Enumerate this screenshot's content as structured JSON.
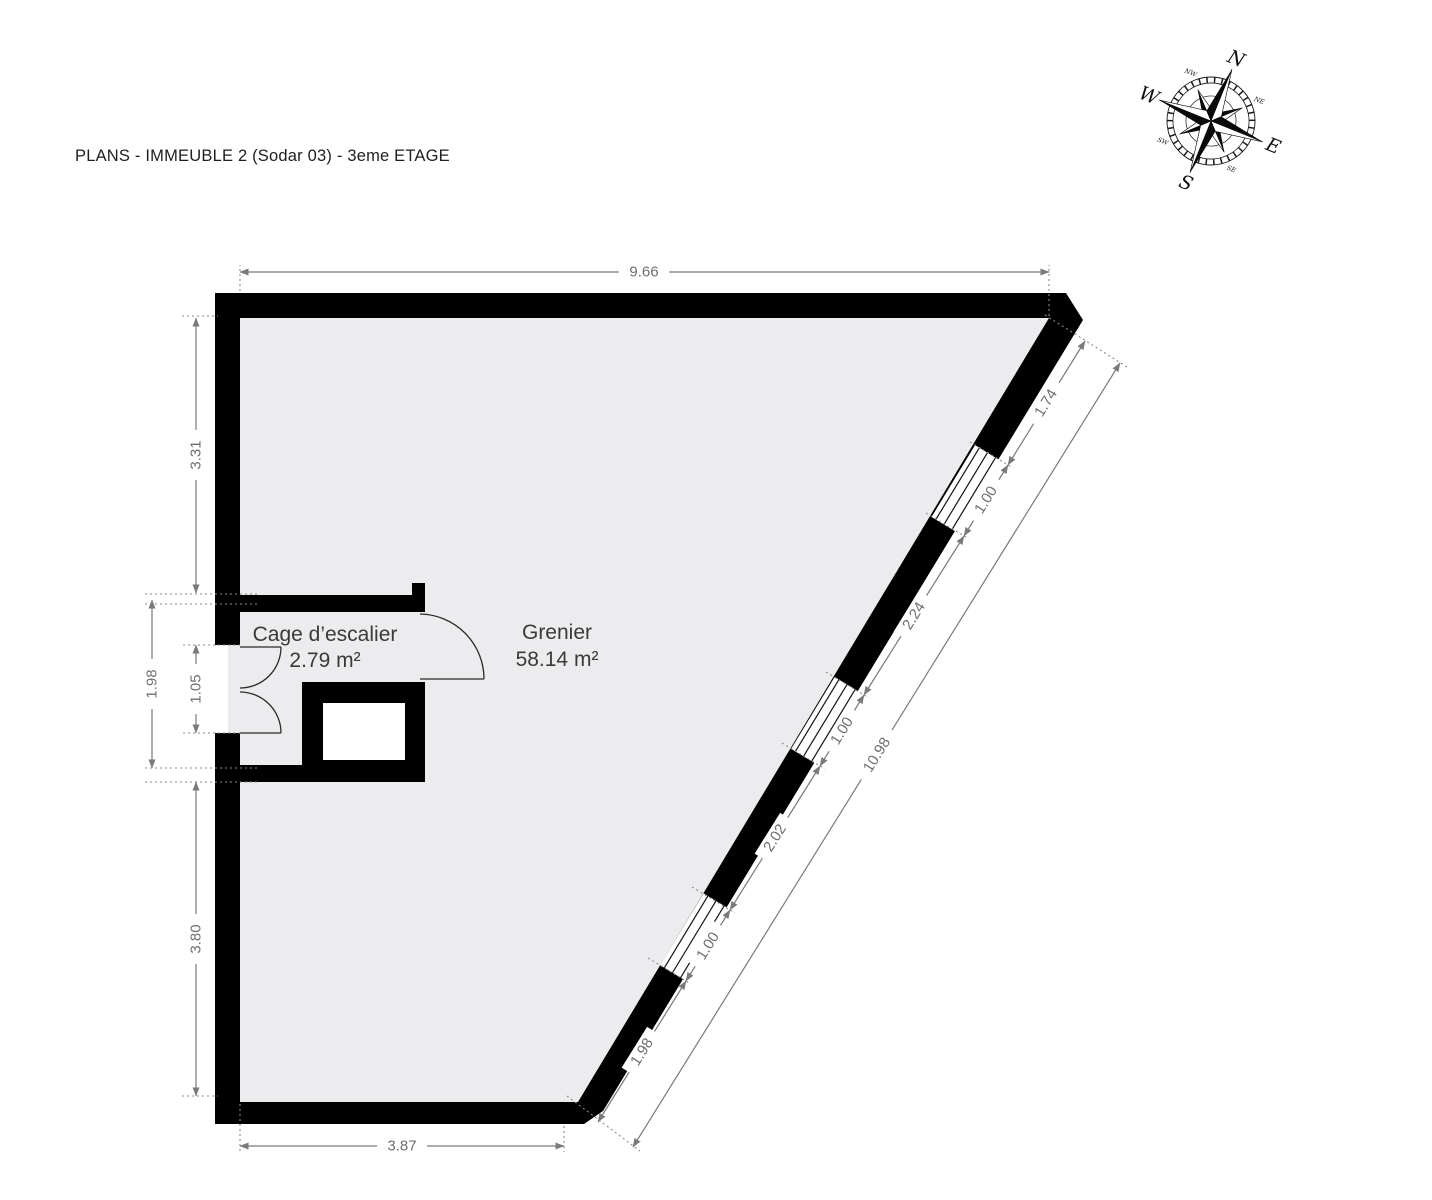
{
  "title": "PLANS - IMMEUBLE 2 (Sodar 03) - 3eme ETAGE",
  "rooms": {
    "stairwell": {
      "name": "Cage d’escalier",
      "area": "2.79 m²"
    },
    "attic": {
      "name": "Grenier",
      "area": "58.14 m²"
    }
  },
  "dimensions": {
    "top": {
      "value": "9.66"
    },
    "left_upper": {
      "value": "3.31"
    },
    "left_middle": {
      "value": "1.98"
    },
    "left_door": {
      "value": "1.05"
    },
    "left_lower": {
      "value": "3.80"
    },
    "bottom": {
      "value": "3.87"
    },
    "diagonal_total": {
      "value": "10.98"
    },
    "diagonal_segments": [
      {
        "value": "1.74"
      },
      {
        "value": "1.00"
      },
      {
        "value": "2.24"
      },
      {
        "value": "1.00"
      },
      {
        "value": "2.02"
      },
      {
        "value": "1.00"
      },
      {
        "value": "1.98"
      }
    ]
  },
  "compass": {
    "north": "N",
    "east": "E",
    "south": "S",
    "west": "W",
    "minor": {
      "nw": "NW",
      "ne": "NE",
      "se": "SE",
      "sw": "SW"
    }
  },
  "colors": {
    "wall": "#000000",
    "floor": "#ececee",
    "dimension": "#7a7a7a",
    "label_text": "#3a3a3a"
  }
}
